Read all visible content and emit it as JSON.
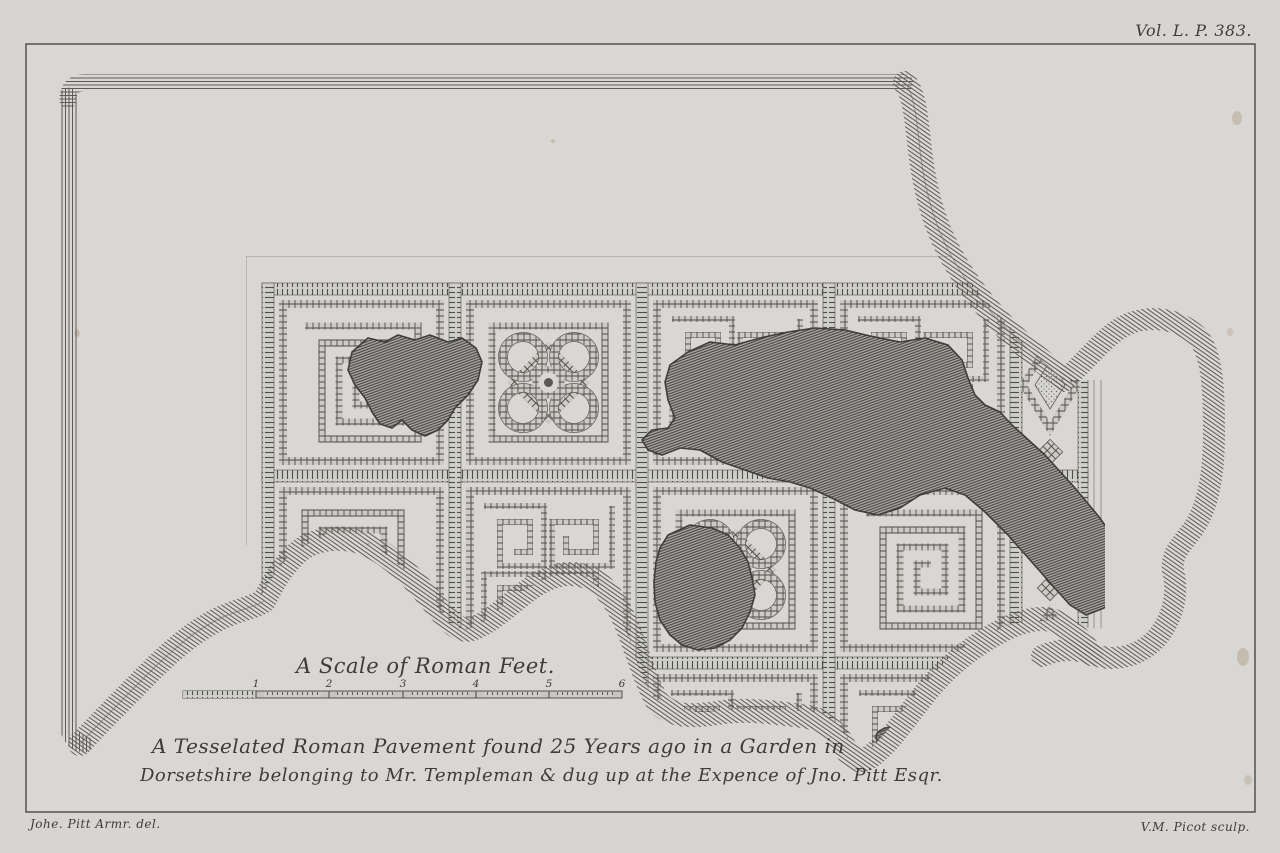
{
  "plate": {
    "volume_label": "Vol. L. P. 383."
  },
  "scale": {
    "title": "A Scale of Roman Feet.",
    "numbers": [
      "1",
      "2",
      "3",
      "4",
      "5",
      "6"
    ]
  },
  "caption": {
    "line1": "A Tesselated Roman Pavement found 25 Years ago in a Garden in",
    "line2": "Dorsetshire belonging to Mr. Templeman & dug up at the Expence of Jno. Pitt Esqr."
  },
  "credits": {
    "delineator": "Johe. Pitt Armr. del.",
    "engraver": "V.M. Picot sculp."
  },
  "artwork": {
    "subject": "Plan of a tessellated Roman pavement (engraved plate)",
    "motifs": [
      "greek-key-meander",
      "rosette-medallion",
      "lozenge-border",
      "damage-lacunae"
    ],
    "colors": {
      "paper": "#d6d5d1",
      "ink": "#4a4844",
      "shading": "#6f6d69"
    }
  }
}
